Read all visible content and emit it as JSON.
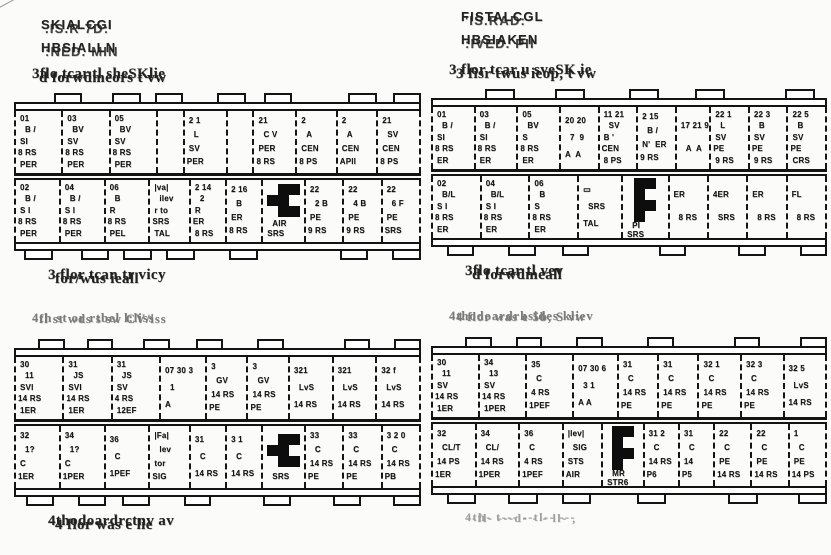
{
  "left_header": {
    "line1a": "SKIALCGI",
    "line1b": ".IS.R 7D:",
    "line2a": "HBSIALLN",
    "line2b": ":NED. MIN"
  },
  "right_header": {
    "line1a": "FISTALCGL",
    "line1b": "'IS.RAD:",
    "line2a": "HBSIAKEN",
    "line2b": ":IVED. PII"
  },
  "marker_name": "black-marker-blob",
  "figures": [
    {
      "id": "top-left",
      "caption_above": {
        "a": "3flo.tcar.tl sheSKlie",
        "b": "d forwdmeors  t vw"
      },
      "caption_below": {
        "a": "3 flor tcan tr vicy",
        "b": "for/wus ieall"
      },
      "row1": [
        {
          "w": 1.0,
          "lines": [
            "01",
            "B /",
            "SI",
            "8 RS",
            "PER"
          ]
        },
        {
          "w": 1.0,
          "lines": [
            "03",
            "BV",
            "SV",
            "8 RS",
            "PER"
          ]
        },
        {
          "w": 1.0,
          "lines": [
            "05",
            "BV",
            "SV",
            "8 RS",
            "PER"
          ]
        },
        {
          "w": 0.55,
          "lines": []
        },
        {
          "w": 0.9,
          "lines": [
            "2 1",
            "L",
            "SV",
            "PER"
          ]
        },
        {
          "w": 0.55,
          "lines": []
        },
        {
          "w": 0.9,
          "lines": [
            "21",
            "C V",
            "PER",
            "8 RS"
          ]
        },
        {
          "w": 0.85,
          "lines": [
            "2",
            "A",
            "CEN",
            "8 PS"
          ]
        },
        {
          "w": 0.85,
          "lines": [
            "2",
            "A",
            "CEN",
            "APIl"
          ]
        },
        {
          "w": 0.9,
          "lines": [
            "21",
            "SV",
            "CEN",
            "8 PS"
          ]
        }
      ],
      "row2": [
        {
          "w": 1.0,
          "lines": [
            "02",
            "B /",
            "S I",
            "8 RS",
            "PER"
          ]
        },
        {
          "w": 1.0,
          "lines": [
            "04",
            "B /",
            "S I",
            "8 RS",
            "PER"
          ]
        },
        {
          "w": 1.0,
          "lines": [
            "06",
            "B",
            "R",
            "8 RS",
            "PEL"
          ]
        },
        {
          "w": 0.9,
          "lines": [
            "|va|",
            "ilev",
            "r to",
            "SRS",
            "TAL"
          ]
        },
        {
          "w": 0.8,
          "lines": [
            "2 14",
            "2",
            "R",
            "ER",
            "8 RS"
          ]
        },
        {
          "w": 0.8,
          "lines": [
            "2 16",
            "B",
            "ER",
            "8 RS"
          ]
        },
        {
          "w": 0.95,
          "marker": "a",
          "lines": [
            "AIR",
            "SRS"
          ]
        },
        {
          "w": 0.85,
          "lines": [
            "22",
            "2 B",
            "PE",
            "9 RS"
          ]
        },
        {
          "w": 0.85,
          "lines": [
            "22",
            "4 B",
            "PE",
            "9 RS"
          ]
        },
        {
          "w": 0.85,
          "lines": [
            "22",
            "6 F",
            "PE",
            "SRS"
          ]
        }
      ]
    },
    {
      "id": "top-right",
      "caption_above": {
        "a": "3 flor tcar u sveSK ie",
        "b": "3 fisr twus ieop, t vw"
      },
      "caption_below": {
        "a": "3flo tcar tl vev",
        "b": "d forwdmeall"
      },
      "row1": [
        {
          "w": 1.0,
          "lines": [
            "01",
            "B /",
            "SI",
            "8 RS",
            "ER"
          ]
        },
        {
          "w": 1.0,
          "lines": [
            "03",
            "B /",
            "SI",
            "8 RS",
            "ER"
          ]
        },
        {
          "w": 1.0,
          "lines": [
            "05",
            "BV",
            "S",
            "8 RS",
            "ER"
          ]
        },
        {
          "w": 0.9,
          "lines": [
            "20 20",
            "7  9",
            "A  A"
          ]
        },
        {
          "w": 0.9,
          "lines": [
            "11 21",
            "SV",
            "B '",
            "CEN",
            "8 PS"
          ]
        },
        {
          "w": 0.9,
          "lines": [
            "2 15",
            "B /",
            "N'  ER",
            "9 RS"
          ]
        },
        {
          "w": 0.8,
          "lines": [
            "17 21 9",
            "A  A"
          ]
        },
        {
          "w": 0.9,
          "lines": [
            "22 1",
            "L",
            "SV",
            "PE",
            "9 RS"
          ]
        },
        {
          "w": 0.9,
          "lines": [
            "22 3",
            "B",
            "SV",
            "PE",
            "9 RS"
          ]
        },
        {
          "w": 0.9,
          "lines": [
            "22 5",
            "B",
            "SV",
            "PE",
            "CRS"
          ]
        }
      ],
      "row2": [
        {
          "w": 1.0,
          "lines": [
            "02",
            "B/L",
            "S I",
            "8 RS",
            "ER"
          ]
        },
        {
          "w": 1.0,
          "lines": [
            "04",
            "B/L",
            "S I",
            "8 RS",
            "ER"
          ]
        },
        {
          "w": 1.0,
          "lines": [
            "06",
            "B",
            "S",
            "8 RS",
            "ER"
          ]
        },
        {
          "w": 0.9,
          "lines": [
            "▭",
            "SRS",
            "TAL"
          ]
        },
        {
          "w": 0.95,
          "marker": "b",
          "lines": [
            "PI",
            "SRS"
          ]
        },
        {
          "w": 0.8,
          "lines": [
            "ER",
            "8 RS"
          ]
        },
        {
          "w": 0.8,
          "lines": [
            "4ER",
            "SRS"
          ]
        },
        {
          "w": 0.8,
          "lines": [
            "ER",
            "8 RS"
          ]
        },
        {
          "w": 0.8,
          "lines": [
            "FL",
            "8 RS"
          ]
        }
      ]
    },
    {
      "id": "bottom-left",
      "caption_above": {
        "a": "4th st or rtbel  l:liss",
        "b": "fl st wds s  sw  CV/iss"
      },
      "caption_below": {
        "a": "4thodoardrctnv av",
        "b": "4 flor was e lie"
      },
      "row1": [
        {
          "w": 1.0,
          "lines": [
            "30",
            "11",
            "SVI",
            "14 RS",
            "1ER"
          ]
        },
        {
          "w": 1.0,
          "lines": [
            "31",
            "JS",
            "SVI",
            "14 RS",
            "1ER"
          ]
        },
        {
          "w": 1.0,
          "lines": [
            "31",
            "JS",
            "SV",
            "4 RS",
            "12EF"
          ]
        },
        {
          "w": 0.95,
          "lines": [
            "07 30 3",
            "1",
            "A"
          ]
        },
        {
          "w": 0.85,
          "lines": [
            "3",
            "GV",
            "14 RS",
            "PE"
          ]
        },
        {
          "w": 0.85,
          "lines": [
            "3",
            "GV",
            "14 RS",
            "PE"
          ]
        },
        {
          "w": 0.9,
          "lines": [
            "321",
            "LvS",
            "14 RS"
          ]
        },
        {
          "w": 0.9,
          "lines": [
            "321",
            "LvS",
            "14 RS"
          ]
        },
        {
          "w": 0.9,
          "lines": [
            "32 f",
            "LvS",
            "14 RS"
          ]
        }
      ],
      "row2": [
        {
          "w": 1.0,
          "lines": [
            "32",
            "1?",
            "C",
            "1ER"
          ]
        },
        {
          "w": 1.0,
          "lines": [
            "34",
            "1?",
            "C",
            "1PER"
          ]
        },
        {
          "w": 1.0,
          "lines": [
            "36",
            "C",
            "1PEF"
          ]
        },
        {
          "w": 0.9,
          "lines": [
            "|Fa|",
            "lev",
            "tor",
            "SIG"
          ]
        },
        {
          "w": 0.8,
          "lines": [
            "31",
            "C",
            "14 RS"
          ]
        },
        {
          "w": 0.8,
          "lines": [
            "3 1",
            "C",
            "14 RS"
          ]
        },
        {
          "w": 0.95,
          "marker": "a",
          "lines": [
            "SRS"
          ]
        },
        {
          "w": 0.85,
          "lines": [
            "33",
            "C",
            "14 RS",
            "PE"
          ]
        },
        {
          "w": 0.85,
          "lines": [
            "33",
            "C",
            "14 RS",
            "PE"
          ]
        },
        {
          "w": 0.85,
          "lines": [
            "3 2 0",
            "C",
            "14 RS",
            "PB"
          ]
        }
      ]
    },
    {
      "id": "bottom-right",
      "caption_above": {
        "a": "4thodoardrhsides kliev",
        "b": "4 flor was e 5b, S vw"
      },
      "caption_below": {
        "a": "4th- t--- --tl-- ---",
        "b": "-fl- ---d- - - ll- ,"
      },
      "row1": [
        {
          "w": 1.0,
          "lines": [
            "30",
            "11",
            "SV",
            "14 RS",
            "1ER"
          ]
        },
        {
          "w": 1.0,
          "lines": [
            "34",
            "13",
            "SV",
            "14 RS",
            "1PER"
          ]
        },
        {
          "w": 1.0,
          "lines": [
            "35",
            "C",
            "4 RS",
            "1PEF"
          ]
        },
        {
          "w": 0.95,
          "lines": [
            "07 30 6",
            "3 1",
            "A A"
          ]
        },
        {
          "w": 0.85,
          "lines": [
            "31",
            "C",
            "14 RS",
            "PE"
          ]
        },
        {
          "w": 0.85,
          "lines": [
            "31",
            "C",
            "14 RS",
            "PE"
          ]
        },
        {
          "w": 0.9,
          "lines": [
            "32 1",
            "C",
            "14 RS",
            "PE"
          ]
        },
        {
          "w": 0.9,
          "lines": [
            "32 3",
            "C",
            "14 RS",
            "PE"
          ]
        },
        {
          "w": 0.9,
          "lines": [
            "32 5",
            "LvS",
            "14 RS"
          ]
        }
      ],
      "row2": [
        {
          "w": 1.0,
          "lines": [
            "32",
            "CL/T",
            "14 PS",
            "1ER"
          ]
        },
        {
          "w": 1.0,
          "lines": [
            "34",
            "CL/",
            "14 RS",
            "1PER"
          ]
        },
        {
          "w": 1.0,
          "lines": [
            "36",
            "C",
            "4 RS",
            "1PEF"
          ]
        },
        {
          "w": 0.9,
          "lines": [
            "|lev|",
            "SIG",
            "STS",
            "AIR"
          ]
        },
        {
          "w": 0.95,
          "marker": "b",
          "lines": [
            "MR",
            "STR6"
          ]
        },
        {
          "w": 0.8,
          "lines": [
            "31 2",
            "C",
            "14 RS",
            "P6"
          ]
        },
        {
          "w": 0.8,
          "lines": [
            "31",
            "C",
            "14",
            "P5"
          ]
        },
        {
          "w": 0.85,
          "lines": [
            "22",
            "C",
            "PE",
            "14 RS"
          ]
        },
        {
          "w": 0.85,
          "lines": [
            "22",
            "C",
            "PE",
            "14 RS"
          ]
        },
        {
          "w": 0.85,
          "lines": [
            "1",
            "C",
            "PE",
            "14 PS"
          ]
        }
      ]
    }
  ]
}
